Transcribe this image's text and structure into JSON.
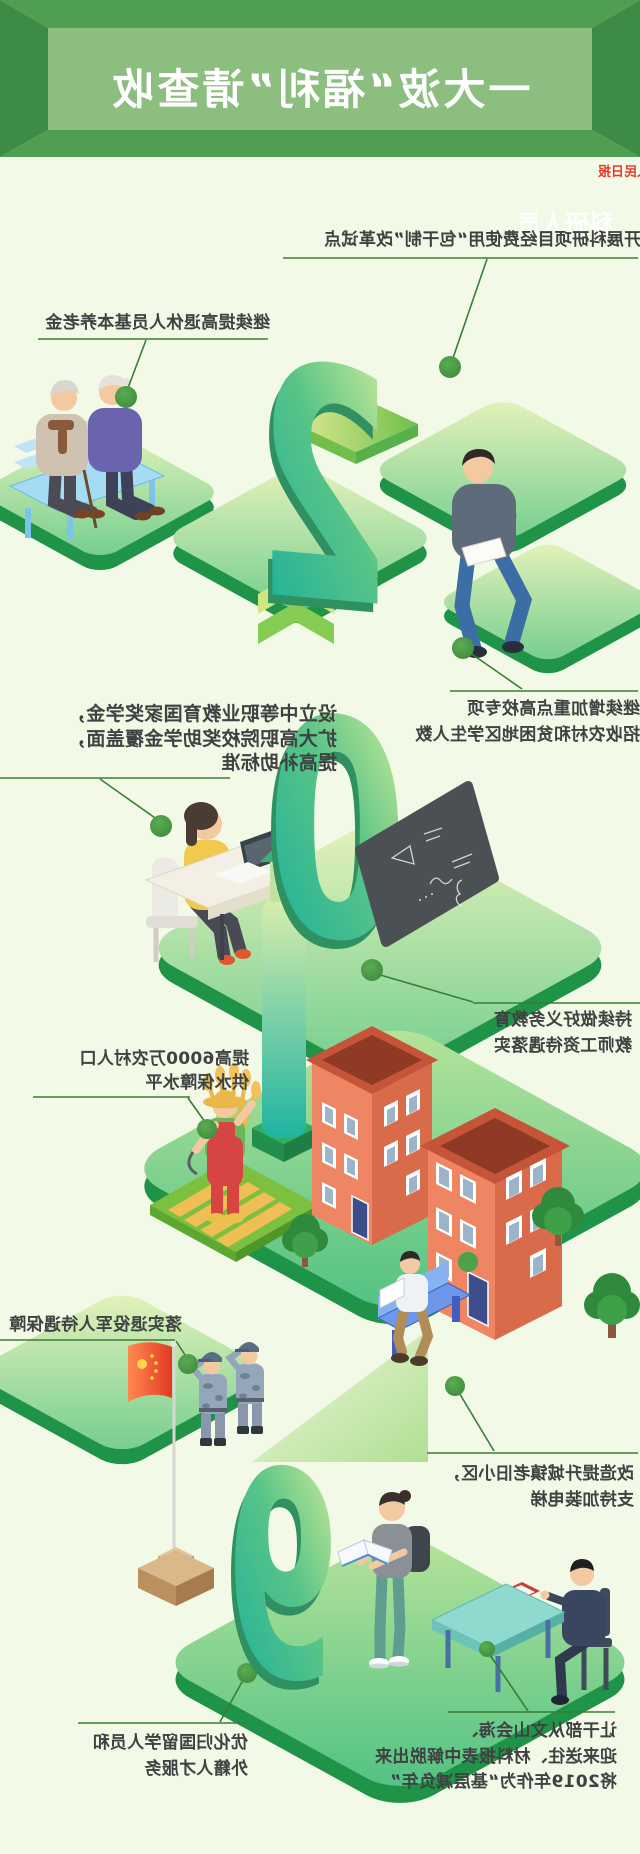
{
  "page": {
    "width": 640,
    "height": 1854,
    "background": "#f3f9e7",
    "note_mirrored": "entire graphic rendered horizontally mirrored"
  },
  "header": {
    "title": "一大波“福利”请查收",
    "outer_green": "#4f9e52",
    "bevel_green": "#3e8b45",
    "panel_green": "#8cbe80",
    "title_color": "#ffffff"
  },
  "credit": {
    "label": "人民日报",
    "color": "#e23b2c"
  },
  "section_label": {
    "text": "科研人员",
    "color": "#ffffff"
  },
  "numerals": [
    "2",
    "0",
    "1",
    "9"
  ],
  "callouts": [
    {
      "id": "research",
      "lines": [
        "开展科研项目经费使用“包干制”改革试点"
      ]
    },
    {
      "id": "pension",
      "lines": [
        "继续提高退休人员基本养老金"
      ]
    },
    {
      "id": "students",
      "lines": [
        "继续增加重点高校专项",
        "招收农村和贫困地区学生人数"
      ]
    },
    {
      "id": "vocational",
      "lines": [
        "设立中等职业教育国家奖学金，",
        "扩大高职院校奖助学金覆盖面，",
        "提高补助标准"
      ]
    },
    {
      "id": "teachers",
      "lines": [
        "持续做好义务教育",
        "教师工资待遇落实"
      ]
    },
    {
      "id": "water",
      "lines": [
        "提高6000万农村人口",
        "供水保障水平"
      ]
    },
    {
      "id": "veterans",
      "lines": [
        "落实退役军人待遇保障"
      ]
    },
    {
      "id": "renovation",
      "lines": [
        "改造提升城镇老旧小区，",
        "支持加装电梯"
      ]
    },
    {
      "id": "burden",
      "lines": [
        "让干部从文山会海、",
        "迎来送往、材料报表中解脱出来",
        "将2019年作为“基层减负年”"
      ]
    },
    {
      "id": "overseas",
      "lines": [
        "优化归国留学人员和",
        "外籍人才服务"
      ]
    }
  ],
  "colors": {
    "accent_green": "#4f9e52",
    "connector_line": "#3a7d35",
    "callout_dot": "#4f9c49",
    "platform_rim": "#1f9348",
    "digit_face": "#57bd7d",
    "building_orange": "#ef8663",
    "flag_red": "#e23a24",
    "text": "#3f4142"
  },
  "icons": [
    {
      "name": "callout-dot",
      "shape": "filled-circle"
    },
    {
      "name": "china-flag",
      "shape": "red-flag-with-stars"
    }
  ],
  "scenes": [
    "elderly-couple-on-bench",
    "young-man-reading",
    "woman-at-computer-desk",
    "blackboard-with-formulas",
    "farmer-with-wheat",
    "water-tower",
    "apartment-buildings",
    "man-on-park-bench",
    "soldiers-saluting-flag",
    "student-reading-book",
    "official-at-desk"
  ]
}
